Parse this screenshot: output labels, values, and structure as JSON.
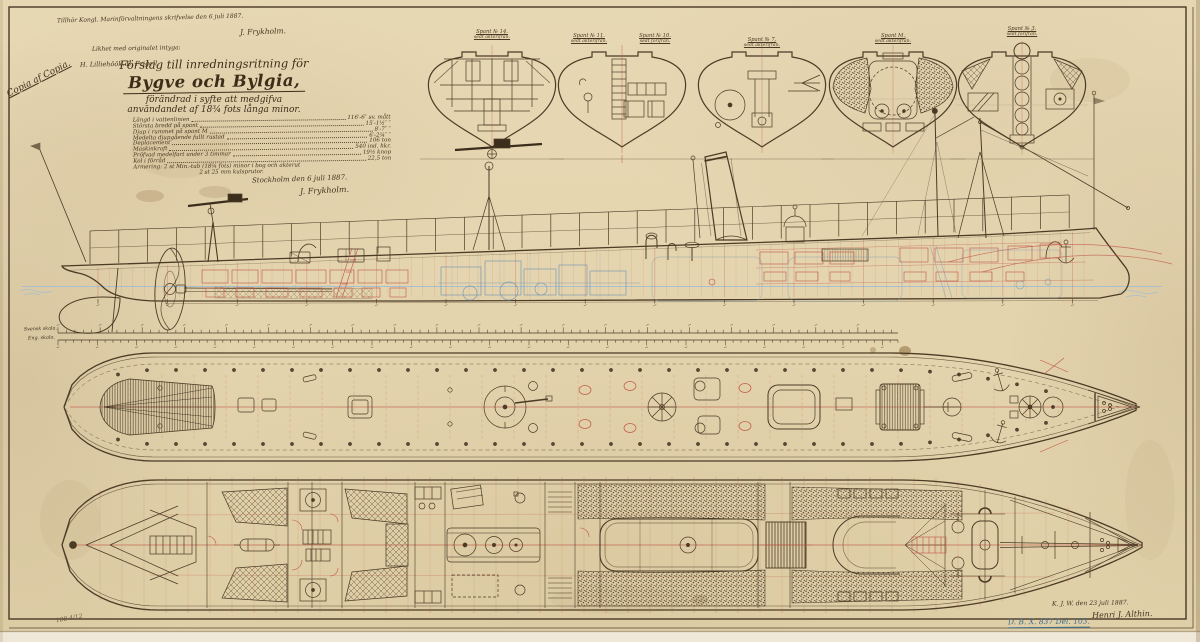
{
  "document": {
    "archival_note": "Tillhör Kongl. Marinförvaltningens skrifvelse den 6 juli 1887.",
    "top_signature": "J. Frykholm.",
    "certification_line1": "Likhet med originalet intyga:",
    "certification_line2": "H. Lilliehöök.   B. Frigell.",
    "copy_stamp": "Copia af Copia.",
    "sheet_number": "188 4/12"
  },
  "title_block": {
    "line1": "Förslag till inredningsritning för",
    "ship_names": "Bygve och Bylgia,",
    "line3": "förändrad i syfte att medgifva",
    "line4": "användandet af 18¾ fots långa minor.",
    "place_date": "Stockholm den 6 juli 1887.",
    "signature": "J. Frykholm."
  },
  "specifications": {
    "rows": [
      {
        "label": "Längd i vattenlinien",
        "value": "116′-6″ sv. mått"
      },
      {
        "label": "Största bredd på spant",
        "value": "15′-1½″  ″"
      },
      {
        "label": "Djup i rummet på spant M",
        "value": "8′-7″  ″"
      },
      {
        "label": "Medelta djupgående fullt rustad",
        "value": "6′-2¾″  ″"
      },
      {
        "label": "Deplacement",
        "value": "106 ton"
      },
      {
        "label": "Maskinkraft",
        "value": "540 ind. hkr."
      },
      {
        "label": "Pröfvad medelfart under 3 timmar",
        "value": "19½ knop"
      },
      {
        "label": "Kol i förråd",
        "value": "22,5 ton"
      },
      {
        "label": "Armering: 2 st Min.-tub (18¾ fots) minor i bog och akterut",
        "value": ""
      },
      {
        "label": "2 st 25 mm kulsprutor.",
        "value": ""
      }
    ]
  },
  "cross_sections": {
    "labels": [
      {
        "line1": "Spant № 14.",
        "line2": "sedt akterifrån."
      },
      {
        "line1": "Spant № 11.",
        "line2": "sedt akterifrån."
      },
      {
        "line1": "Spant № 10.",
        "line2": "sedt förifrån."
      },
      {
        "line1": "Spant № 7.",
        "line2": "sedt akterifrån."
      },
      {
        "line1": "Spant M.",
        "line2": "sedt akterifrån."
      },
      {
        "line1": "Spant № 3.",
        "line2": "sedt förifrån."
      }
    ]
  },
  "scale_bars": {
    "swedish": "Svensk skala.",
    "english": "Eng. skala."
  },
  "approval": {
    "date_note": "K. J. W. den 23 juli 1887.",
    "signature": "Henri J. Althin.",
    "archive_number": "D. B. X. 837 Del. 103."
  },
  "colors": {
    "paper": "#e5d6b2",
    "ink": "#4c3b25",
    "red_ink": "#c05848",
    "blue_ink": "#7e9ab4"
  }
}
